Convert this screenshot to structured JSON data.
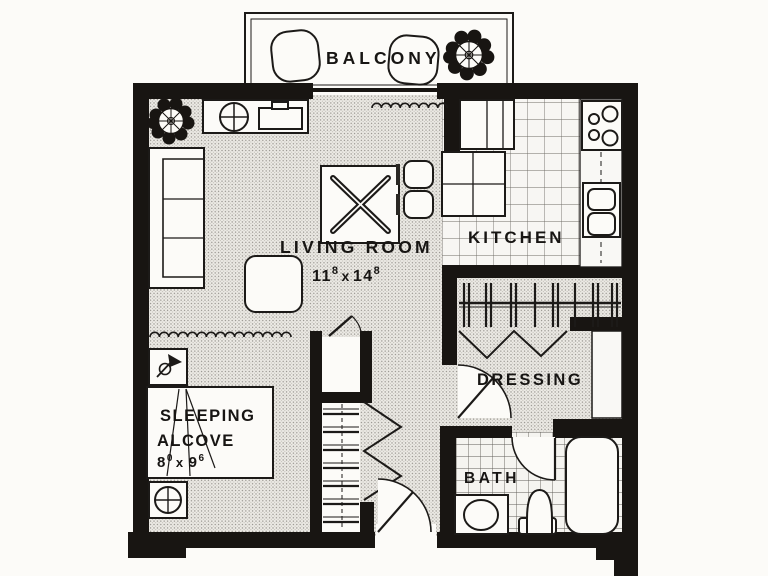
{
  "page": {
    "title": "Studio apartment floor plan"
  },
  "rooms": {
    "balcony": {
      "label": "BALCONY"
    },
    "living_room": {
      "label": "LIVING ROOM",
      "dim_a": "11",
      "dim_a_sup": "8",
      "dim_sep": "x",
      "dim_b": "14",
      "dim_b_sup": "8"
    },
    "kitchen": {
      "label": "KITCHEN"
    },
    "dressing": {
      "label": "DRESSING"
    },
    "bath": {
      "label": "BATH"
    },
    "sleeping_alcove": {
      "label_a": "SLEEPING",
      "label_b": "ALCOVE",
      "dim_a": "8",
      "dim_a_sup": "0",
      "dim_sep": "x",
      "dim_b": "9",
      "dim_b_sup": "6"
    }
  },
  "icons": {
    "tree-icon": "dark foliage ring with pinwheel center",
    "ceiling-lamp-icon": "circle with cross",
    "wall-lamp-icon": "triangle with small circle",
    "folding-table-icon": "square with crossed bars",
    "stove-icon": "four burner circles",
    "sink-icon": "double bowl"
  },
  "colors": {
    "wall": "#181512",
    "paper": "#fcfbf8",
    "floor_dot": "#93908a",
    "line": "#1c1a18"
  }
}
